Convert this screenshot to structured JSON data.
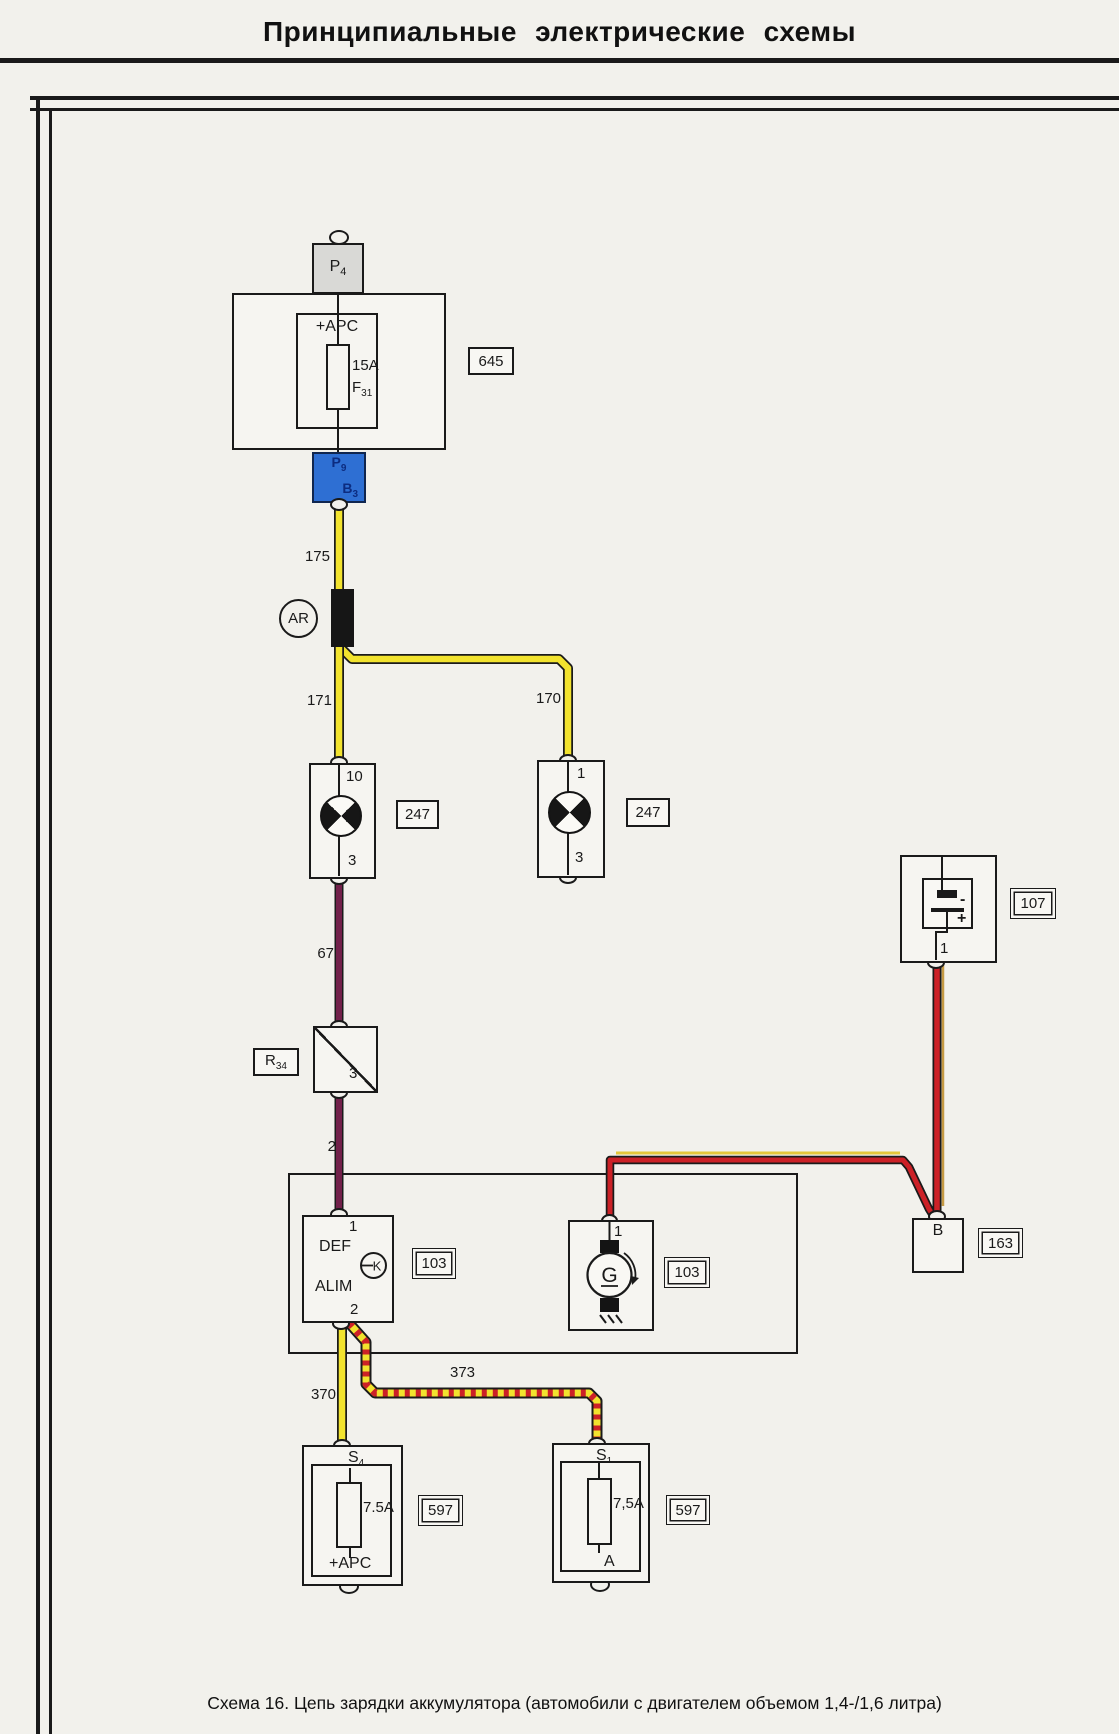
{
  "title": "Принципиальные  электрические  схемы",
  "caption": "Схема 16. Цепь зарядки аккумулятора (автомобили с двигателем объемом 1,4-/1,6 литра)",
  "colors": {
    "wire_yellow": "#f2e32e",
    "wire_purple": "#72204a",
    "wire_red": "#cc2127",
    "wire_tan": "#c59a43",
    "connector_blue": "#2e6fd3",
    "connector_blue_text": "#0c2c80",
    "line_black": "#1a1a1a"
  },
  "splice": {
    "label": "AR"
  },
  "wires": {
    "w175": "175",
    "w170": "170",
    "w171": "171",
    "w67": "67",
    "w2": "2",
    "w370": "370",
    "w373": "373"
  },
  "fusebox": {
    "ref": "645",
    "connector_top": {
      "main": "P",
      "sub": "4"
    },
    "feed": "+APC",
    "fuse_rating": "15A",
    "fuse_id": {
      "main": "F",
      "sub": "31"
    },
    "connector_bottom_row1": {
      "main": "P",
      "sub": "9"
    },
    "connector_bottom_row2": {
      "main": "B",
      "sub": "3"
    }
  },
  "lamp_left": {
    "ref": "247",
    "pin_top": "10",
    "pin_bottom": "3"
  },
  "lamp_right": {
    "ref": "247",
    "pin_top": "1",
    "pin_bottom": "3"
  },
  "r34": {
    "label": {
      "main": "R",
      "sub": "34"
    },
    "pin": "3"
  },
  "regulator": {
    "ref": "103",
    "pin_top": "1",
    "line1": "DEF",
    "line2": "ALIM",
    "symbol": "K",
    "pin_bottom": "2"
  },
  "generator": {
    "ref": "103",
    "pin_top": "1",
    "symbol": "G"
  },
  "battery": {
    "ref": "107",
    "minus": "-",
    "plus": "+",
    "pin": "1"
  },
  "junction163": {
    "ref": "163",
    "pin": "B"
  },
  "fuse_s4": {
    "ref": "597",
    "name": {
      "main": "S",
      "sub": "4"
    },
    "rating": "7.5A",
    "feed": "+APC"
  },
  "fuse_s1": {
    "ref": "597",
    "name": {
      "main": "S",
      "sub": "1"
    },
    "rating": "7,5A",
    "feed": "A"
  }
}
